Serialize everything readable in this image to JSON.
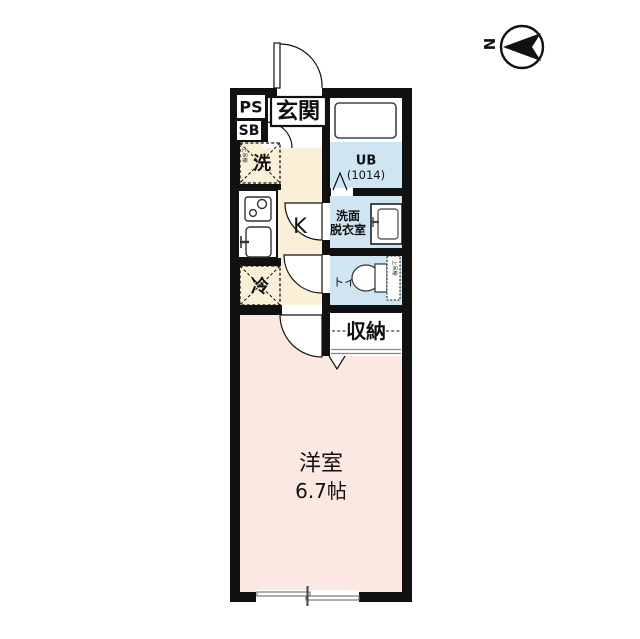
{
  "compass": {
    "north_label": "N"
  },
  "labels": {
    "ps": "PS",
    "sb": "SB",
    "entrance": "玄関",
    "washer": "洗",
    "washer_note": "上吊棚",
    "kitchen": "K",
    "fridge": "冷",
    "unit_bath_line1": "UB",
    "unit_bath_line2": "(1014)",
    "washroom_line1": "洗面",
    "washroom_line2": "脱衣室",
    "toilet": "トイレ",
    "toilet_note": "上吊棚",
    "closet": "収納",
    "room_name": "洋室",
    "room_size": "6.7帖"
  },
  "colors": {
    "wall": "#111111",
    "hall_floor": "#faf0d7",
    "wet_area_floor": "#cfe6f2",
    "room_floor": "#fbe8e1",
    "background": "#ffffff"
  }
}
